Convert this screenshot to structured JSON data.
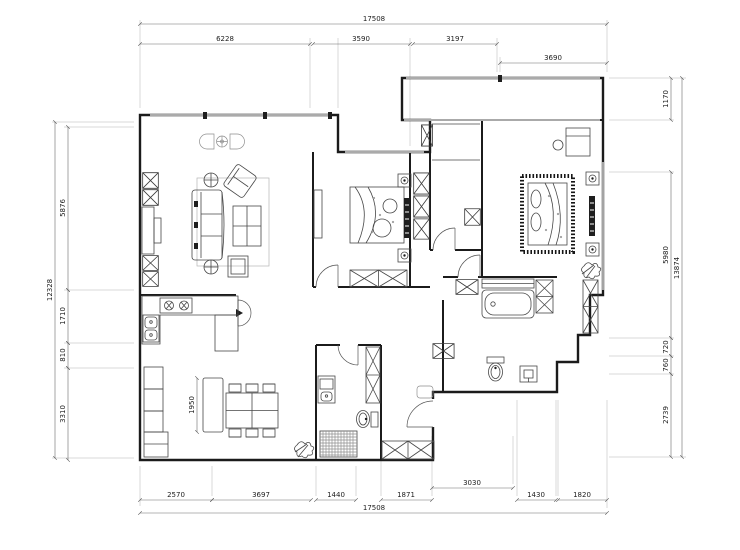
{
  "dims": {
    "top": {
      "total": "17508",
      "segs": [
        "6228",
        "3590",
        "3197"
      ],
      "balcony": "3690"
    },
    "bottom": {
      "total": "17508",
      "segs": [
        "2570",
        "3697",
        "1440",
        "1871",
        "3030",
        "1430",
        "1820"
      ]
    },
    "left": {
      "total": "12328",
      "segs": [
        "5876",
        "1710",
        "810",
        "3310"
      ]
    },
    "right": {
      "total": "13874",
      "segs": [
        "1170",
        "5980",
        "720",
        "760",
        "2739"
      ]
    },
    "interior": {
      "island": "1950"
    }
  }
}
